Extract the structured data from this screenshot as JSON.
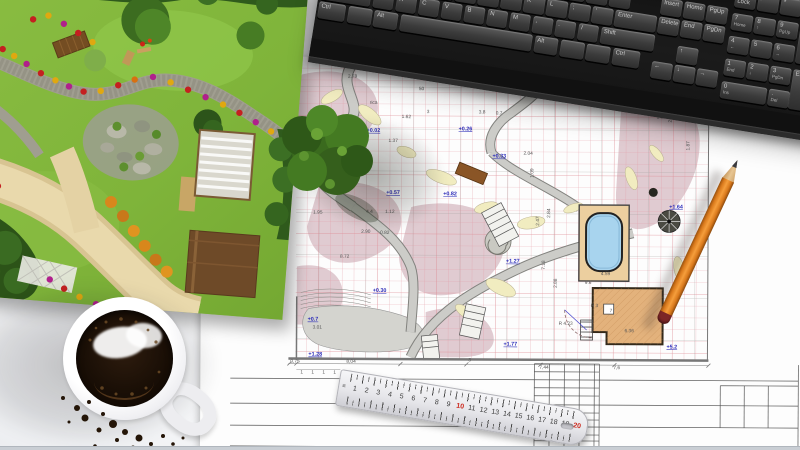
{
  "scene": {
    "description": "Top view of a landscape designer desk: 3D garden render print, garden landscape blueprint plan, black computer keyboard, cup of black coffee with crumbs, metal ruler and orange pencil on white desk"
  },
  "colors": {
    "grid_pink": "#e49aa4",
    "elevation_blue": "#2a2ab8",
    "pool_blue": "#a8d4ee",
    "house_tan": "#e3b27c",
    "pencil_orange": "#d9791c",
    "ruler_red": "#cc2a1e",
    "lawn_green": "#7fb43a"
  },
  "keyboard": {
    "unit": 20.5,
    "gap": 2.5,
    "key_h": 17,
    "blocks": [
      {
        "x": 112,
        "y": 32,
        "keys": [
          {
            "t": "5"
          },
          {
            "t": "6"
          },
          {
            "t": "7"
          },
          {
            "t": "8"
          },
          {
            "t": "9"
          },
          {
            "t": "0"
          },
          {
            "t": "-"
          },
          {
            "t": "="
          },
          {
            "t": "Backspace",
            "u": 2.1
          }
        ]
      },
      {
        "x": 2,
        "y": 51,
        "keys": [
          {
            "t": "Tab",
            "u": 1.45
          },
          {
            "t": "Q"
          },
          {
            "t": "W"
          },
          {
            "t": "E"
          },
          {
            "t": "R"
          },
          {
            "t": "T"
          },
          {
            "t": "Y"
          },
          {
            "t": "U"
          },
          {
            "t": "I"
          },
          {
            "t": "O"
          },
          {
            "t": "P"
          },
          {
            "t": "["
          },
          {
            "t": "]"
          }
        ]
      },
      {
        "x": 2,
        "y": 70,
        "keys": [
          {
            "t": "Caps Lock",
            "u": 1.8
          },
          {
            "t": "A"
          },
          {
            "t": "S"
          },
          {
            "t": "D"
          },
          {
            "t": "F"
          },
          {
            "t": "G"
          },
          {
            "t": "H"
          },
          {
            "t": "J"
          },
          {
            "t": "K"
          },
          {
            "t": "L"
          },
          {
            "t": ";"
          },
          {
            "t": "'"
          },
          {
            "t": "Enter",
            "u": 1.9
          }
        ]
      },
      {
        "x": 2,
        "y": 89,
        "keys": [
          {
            "t": "Shift",
            "u": 2.3
          },
          {
            "t": "Z"
          },
          {
            "t": "X"
          },
          {
            "t": "C"
          },
          {
            "t": "V"
          },
          {
            "t": "B"
          },
          {
            "t": "N"
          },
          {
            "t": "M"
          },
          {
            "t": ","
          },
          {
            "t": "."
          },
          {
            "t": "/"
          },
          {
            "t": "Shift",
            "u": 2.45
          }
        ]
      },
      {
        "x": 2,
        "y": 108,
        "keys": [
          {
            "t": "Ctrl",
            "u": 1.3
          },
          {
            "t": "",
            "u": 1.15
          },
          {
            "t": "Alt",
            "u": 1.15
          },
          {
            "t": "",
            "u": 5.9
          },
          {
            "t": "Alt",
            "u": 1.15
          },
          {
            "t": "",
            "u": 1.15
          },
          {
            "t": "",
            "u": 1.15
          },
          {
            "t": "Ctrl",
            "u": 1.3
          }
        ]
      },
      {
        "x": 340,
        "y": 51,
        "keys": [
          {
            "t": "Insert"
          },
          {
            "t": "Home"
          },
          {
            "t": "PgUp"
          }
        ]
      },
      {
        "x": 340,
        "y": 70,
        "keys": [
          {
            "t": "Delete"
          },
          {
            "t": "End"
          },
          {
            "t": "PgDn"
          }
        ]
      },
      {
        "x": 363,
        "y": 96,
        "keys": [
          {
            "t": "↑"
          }
        ]
      },
      {
        "x": 340,
        "y": 115,
        "keys": [
          {
            "t": "←"
          },
          {
            "t": "↓"
          },
          {
            "t": "→"
          }
        ]
      },
      {
        "x": 412,
        "y": 32,
        "keys": [
          {
            "t": "Num Lock"
          },
          {
            "t": "/"
          },
          {
            "t": "*"
          },
          {
            "t": "-"
          }
        ]
      },
      {
        "x": 412,
        "y": 55,
        "keys": [
          {
            "t": "7",
            "sub": "Home"
          },
          {
            "t": "8",
            "sub": "↑"
          },
          {
            "t": "9",
            "sub": "PgUp"
          },
          {
            "t": "+",
            "h": 40
          }
        ]
      },
      {
        "x": 412,
        "y": 78,
        "keys": [
          {
            "t": "4",
            "sub": "←"
          },
          {
            "t": "5"
          },
          {
            "t": "6",
            "sub": "→"
          }
        ]
      },
      {
        "x": 412,
        "y": 101,
        "keys": [
          {
            "t": "1",
            "sub": "End"
          },
          {
            "t": "2",
            "sub": "↓"
          },
          {
            "t": "3",
            "sub": "PgDn"
          },
          {
            "t": "Enter",
            "h": 40
          }
        ]
      },
      {
        "x": 412,
        "y": 124,
        "keys": [
          {
            "t": "0",
            "sub": "Ins",
            "u": 2.1
          },
          {
            "t": ".",
            "sub": "Del"
          }
        ]
      }
    ]
  },
  "ruler": {
    "numbers": [
      {
        "t": "1"
      },
      {
        "t": "2"
      },
      {
        "t": "3"
      },
      {
        "t": "4"
      },
      {
        "t": "5"
      },
      {
        "t": "6"
      },
      {
        "t": "7"
      },
      {
        "t": "8"
      },
      {
        "t": "9"
      },
      {
        "t": "10",
        "red": true
      },
      {
        "t": "11"
      },
      {
        "t": "12"
      },
      {
        "t": "13"
      },
      {
        "t": "14"
      },
      {
        "t": "15"
      },
      {
        "t": "16"
      },
      {
        "t": "17"
      },
      {
        "t": "18"
      },
      {
        "t": "19"
      },
      {
        "t": "20",
        "red": true
      }
    ]
  },
  "blueprint": {
    "dims": [
      {
        "x": 146,
        "y": 21,
        "t": "2.78"
      },
      {
        "x": 200,
        "y": 61,
        "t": "1.62"
      },
      {
        "x": 187,
        "y": 85,
        "t": "1.37"
      },
      {
        "x": 225,
        "y": 56,
        "t": "3"
      },
      {
        "x": 277,
        "y": 56,
        "t": "3.8"
      },
      {
        "x": 294,
        "y": 57,
        "t": "0.7"
      },
      {
        "x": 322,
        "y": 97,
        "t": "2.04"
      },
      {
        "x": 139,
        "y": 201,
        "t": "8.72"
      },
      {
        "x": 165,
        "y": 156,
        "t": "4.4"
      },
      {
        "x": 184,
        "y": 156,
        "t": "1.12"
      },
      {
        "x": 112,
        "y": 157,
        "t": "1.95"
      },
      {
        "x": 160,
        "y": 176,
        "t": "2.90"
      },
      {
        "x": 179,
        "y": 177,
        "t": "0.82"
      },
      {
        "x": 112,
        "y": 272,
        "t": "3.01"
      },
      {
        "x": 338,
        "y": 168,
        "t": "2.47",
        "v": true
      },
      {
        "x": 349,
        "y": 160,
        "t": "2.84",
        "v": true
      },
      {
        "x": 344,
        "y": 212,
        "t": "7.18",
        "v": true
      },
      {
        "x": 332,
        "y": 120,
        "t": "1.09",
        "v": true
      },
      {
        "x": 356,
        "y": 230,
        "t": "2.88",
        "v": true
      },
      {
        "x": 470,
        "y": 64,
        "t": "2.3",
        "v": true
      },
      {
        "x": 488,
        "y": 92,
        "t": "1.87",
        "v": true
      },
      {
        "x": 90,
        "y": 306,
        "t": "0,75"
      },
      {
        "x": 146,
        "y": 306,
        "t": "8,04"
      },
      {
        "x": 268,
        "y": 304,
        "t": "3"
      },
      {
        "x": 339,
        "y": 311,
        "t": "7,44"
      },
      {
        "x": 413,
        "y": 311,
        "t": "7,6"
      },
      {
        "x": 100,
        "y": 317,
        "t": "1"
      },
      {
        "x": 111,
        "y": 317,
        "t": "1"
      },
      {
        "x": 122,
        "y": 317,
        "t": "1"
      },
      {
        "x": 133,
        "y": 317,
        "t": "1"
      },
      {
        "x": 400,
        "y": 217,
        "t": "4.59"
      },
      {
        "x": 384,
        "y": 226,
        "t": "9.6"
      },
      {
        "x": 390,
        "y": 249,
        "t": "R 3"
      },
      {
        "x": 358,
        "y": 267,
        "t": "R 4.23"
      },
      {
        "x": 424,
        "y": 274,
        "t": "6.36"
      },
      {
        "x": 409,
        "y": 254,
        "t": "7"
      },
      {
        "x": 217,
        "y": 33,
        "t": "50"
      },
      {
        "x": 300,
        "y": 20,
        "t": "1.4"
      },
      {
        "x": 430,
        "y": 40,
        "t": "0.98"
      },
      {
        "x": 455,
        "y": 60,
        "t": "1.5"
      },
      {
        "x": 168,
        "y": 47,
        "t": "rica"
      }
    ],
    "elevations": [
      {
        "x": 165,
        "y": 75,
        "t": "+0.02"
      },
      {
        "x": 257,
        "y": 73,
        "t": "+0.26"
      },
      {
        "x": 291,
        "y": 100,
        "t": "+0.33"
      },
      {
        "x": 185,
        "y": 137,
        "t": "+0.57"
      },
      {
        "x": 242,
        "y": 138,
        "t": "+0.82"
      },
      {
        "x": 172,
        "y": 235,
        "t": "+0.30"
      },
      {
        "x": 107,
        "y": 264,
        "t": "+0.7"
      },
      {
        "x": 305,
        "y": 205,
        "t": "+1.27"
      },
      {
        "x": 303,
        "y": 288,
        "t": "+1.77"
      },
      {
        "x": 468,
        "y": 150,
        "t": "+1.64"
      },
      {
        "x": 466,
        "y": 290,
        "t": "+5.2"
      },
      {
        "x": 108,
        "y": 299,
        "t": "+1.28"
      }
    ]
  },
  "garden": {
    "flowers": [
      {
        "x": 30,
        "y": 92,
        "c": "#c42020"
      },
      {
        "x": 42,
        "y": 98,
        "c": "#e0a810"
      },
      {
        "x": 55,
        "y": 105,
        "c": "#b0208c"
      },
      {
        "x": 70,
        "y": 113,
        "c": "#c42020"
      },
      {
        "x": 85,
        "y": 119,
        "c": "#e0a810"
      },
      {
        "x": 99,
        "y": 124,
        "c": "#b0208c"
      },
      {
        "x": 114,
        "y": 128,
        "c": "#c42020"
      },
      {
        "x": 131,
        "y": 126,
        "c": "#e0a810"
      },
      {
        "x": 148,
        "y": 119,
        "c": "#c42020"
      },
      {
        "x": 164,
        "y": 112,
        "c": "#d87010"
      },
      {
        "x": 182,
        "y": 108,
        "c": "#b0208c"
      },
      {
        "x": 200,
        "y": 112,
        "c": "#e0a810"
      },
      {
        "x": 218,
        "y": 118,
        "c": "#c42020"
      },
      {
        "x": 236,
        "y": 124,
        "c": "#b0208c"
      },
      {
        "x": 254,
        "y": 130,
        "c": "#e0a810"
      },
      {
        "x": 271,
        "y": 137,
        "c": "#c42020"
      },
      {
        "x": 288,
        "y": 145,
        "c": "#b0208c"
      },
      {
        "x": 304,
        "y": 153,
        "c": "#e0a810"
      },
      {
        "x": 8,
        "y": 150,
        "c": "#c42020"
      },
      {
        "x": 18,
        "y": 163,
        "c": "#e0a810"
      },
      {
        "x": 10,
        "y": 176,
        "c": "#b0208c"
      },
      {
        "x": 21,
        "y": 189,
        "c": "#c42020"
      },
      {
        "x": 13,
        "y": 203,
        "c": "#e0a810"
      },
      {
        "x": 26,
        "y": 216,
        "c": "#b0208c"
      },
      {
        "x": 36,
        "y": 229,
        "c": "#c42020"
      },
      {
        "x": 30,
        "y": 240,
        "c": "#e0a810"
      },
      {
        "x": 95,
        "y": 318,
        "c": "#b0208c"
      },
      {
        "x": 110,
        "y": 326,
        "c": "#c42020"
      },
      {
        "x": 126,
        "y": 333,
        "c": "#e0a810"
      },
      {
        "x": 143,
        "y": 339,
        "c": "#b0208c"
      },
      {
        "x": 160,
        "y": 343,
        "c": "#c42020"
      },
      {
        "x": 58,
        "y": 60,
        "c": "#c42020"
      },
      {
        "x": 73,
        "y": 55,
        "c": "#e0a810"
      },
      {
        "x": 89,
        "y": 62,
        "c": "#b0208c"
      },
      {
        "x": 104,
        "y": 70,
        "c": "#c42020"
      },
      {
        "x": 119,
        "y": 78,
        "c": "#e0a810"
      },
      {
        "x": 150,
        "y": 236,
        "c": "#d8871c",
        "r": 6
      },
      {
        "x": 163,
        "y": 249,
        "c": "#c8781a",
        "r": 6
      },
      {
        "x": 175,
        "y": 263,
        "c": "#e09420",
        "r": 6
      },
      {
        "x": 187,
        "y": 277,
        "c": "#d8871c",
        "r": 6
      },
      {
        "x": 199,
        "y": 290,
        "c": "#c8781a",
        "r": 6
      },
      {
        "x": 211,
        "y": 301,
        "c": "#e09420",
        "r": 6
      },
      {
        "x": 150,
        "y": 160,
        "c": "#5d8f2e",
        "r": 4.5
      },
      {
        "x": 175,
        "y": 188,
        "c": "#6a9c34",
        "r": 4.5
      },
      {
        "x": 190,
        "y": 165,
        "c": "#578a2a",
        "r": 4.5
      },
      {
        "x": 160,
        "y": 200,
        "c": "#5d8f2e",
        "r": 4.5
      }
    ]
  },
  "cup": {
    "crumbs": [
      {
        "x": 8,
        "y": 6,
        "r": 2
      },
      {
        "x": 22,
        "y": 16,
        "r": 3
      },
      {
        "x": 34,
        "y": 10,
        "r": 2
      },
      {
        "x": 30,
        "y": 26,
        "r": 3.5
      },
      {
        "x": 48,
        "y": 22,
        "r": 2
      },
      {
        "x": 58,
        "y": 32,
        "r": 4
      },
      {
        "x": 44,
        "y": 38,
        "r": 2.5
      },
      {
        "x": 70,
        "y": 40,
        "r": 3
      },
      {
        "x": 62,
        "y": 48,
        "r": 2
      },
      {
        "x": 84,
        "y": 46,
        "r": 3.5
      },
      {
        "x": 96,
        "y": 52,
        "r": 2
      },
      {
        "x": 78,
        "y": 56,
        "r": 2.5
      },
      {
        "x": 108,
        "y": 44,
        "r": 2
      },
      {
        "x": 118,
        "y": 52,
        "r": 1.8
      },
      {
        "x": 90,
        "y": 60,
        "r": 1.5
      },
      {
        "x": 14,
        "y": 30,
        "r": 1.5
      },
      {
        "x": 40,
        "y": 54,
        "r": 1.8
      },
      {
        "x": 128,
        "y": 46,
        "r": 1.5
      }
    ],
    "bubbles": [
      {
        "x": 30,
        "y": 12,
        "r": 1.5
      },
      {
        "x": 45,
        "y": 9,
        "r": 1.8
      },
      {
        "x": 60,
        "y": 12,
        "r": 1.5
      },
      {
        "x": 72,
        "y": 20,
        "r": 1.4
      },
      {
        "x": 20,
        "y": 18,
        "r": 1.3
      },
      {
        "x": 14,
        "y": 30,
        "r": 1.5
      },
      {
        "x": 80,
        "y": 32,
        "r": 1.6
      },
      {
        "x": 26,
        "y": 78,
        "r": 1.8
      },
      {
        "x": 40,
        "y": 84,
        "r": 1.5
      },
      {
        "x": 56,
        "y": 84,
        "r": 1.8
      },
      {
        "x": 70,
        "y": 78,
        "r": 1.5
      },
      {
        "x": 83,
        "y": 62,
        "r": 1.4
      }
    ]
  }
}
